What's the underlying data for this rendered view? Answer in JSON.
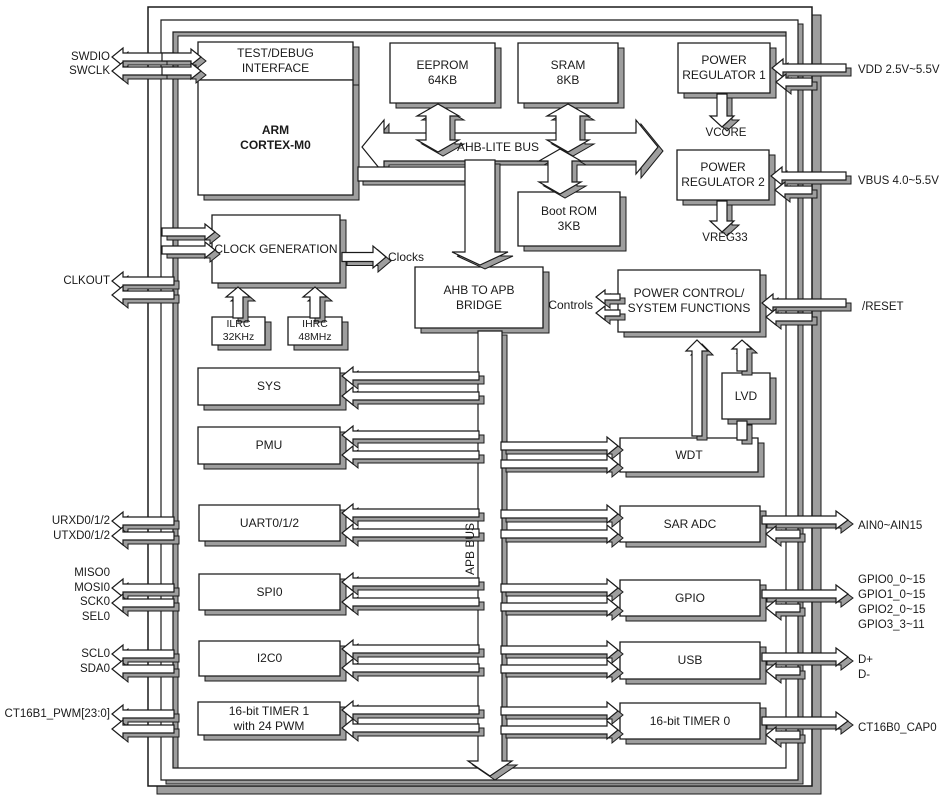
{
  "title": "MCU block diagram",
  "colors": {
    "outline": "#1a1a1a",
    "fill": "#ffffff",
    "shadow": "#9e9e9e",
    "text": "#1a1a1a"
  },
  "blocks": {
    "test_debug": "TEST/DEBUG\nINTERFACE",
    "arm": "ARM\nCORTEX-M0",
    "eeprom": "EEPROM\n64KB",
    "sram": "SRAM\n8KB",
    "reg1": "POWER\nREGULATOR 1",
    "reg2": "POWER\nREGULATOR 2",
    "bootrom": "Boot ROM\n3KB",
    "clockgen": "CLOCK GENERATION",
    "ilrc": "ILRC\n32KHz",
    "ihrc": "IHRC\n48MHz",
    "bridge": "AHB TO APB\nBRIDGE",
    "pwrctl": "POWER CONTROL/\nSYSTEM FUNCTIONS",
    "lvd": "LVD",
    "sys": "SYS",
    "pmu": "PMU",
    "wdt": "WDT",
    "uart": "UART0/1/2",
    "saradc": "SAR ADC",
    "spi": "SPI0",
    "gpio": "GPIO",
    "i2c": "I2C0",
    "usb": "USB",
    "timer1": "16-bit TIMER 1\nwith 24 PWM",
    "timer0": "16-bit TIMER 0"
  },
  "bus_labels": {
    "ahb": "AHB-LITE BUS",
    "apb": "APB BUS",
    "clocks": "Clocks",
    "controls": "Controls"
  },
  "net_labels": {
    "vcore": "VCORE",
    "vreg33": "VREG33"
  },
  "pins": {
    "left": [
      "SWDIO",
      "SWCLK",
      "CLKOUT",
      "URXD0/1/2",
      "UTXD0/1/2",
      "MISO0",
      "MOSI0",
      "SCK0",
      "SEL0",
      "SCL0",
      "SDA0",
      "CT16B1_PWM[23:0]"
    ],
    "right": [
      "VDD 2.5V~5.5V",
      "VBUS 4.0~5.5V",
      "/RESET",
      "AIN0~AIN15",
      "GPIO0_0~15",
      "GPIO1_0~15",
      "GPIO2_0~15",
      "GPIO3_3~11",
      "D+",
      "D-",
      "CT16B0_CAP0"
    ]
  }
}
